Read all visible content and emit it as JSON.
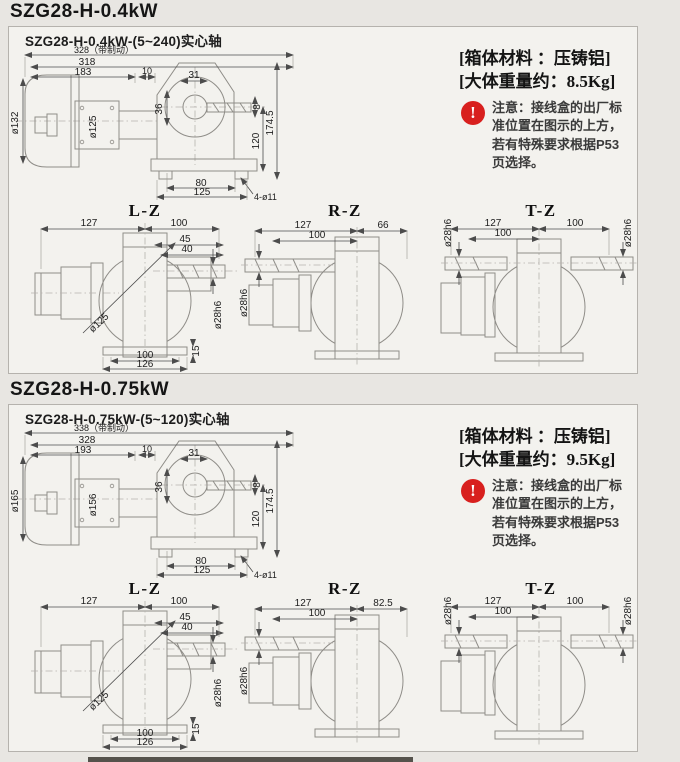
{
  "colors": {
    "page_bg": "#e8e6e2",
    "panel_bg": "#f3f2ee",
    "panel_border": "#b5b2ad",
    "outline_gray": "#8f8d88",
    "dim_line": "#4c4c4c",
    "warning_red": "#d8201e",
    "text_dark": "#151515"
  },
  "icons": {
    "warning": "!"
  },
  "sections": [
    {
      "title": "SZG28-H-0.4kW",
      "subtitle": "SZG28-H-0.4kW-(5~240)实心轴",
      "spec_material": "[箱体材料 ：压铸铝]",
      "spec_weight": "[大体重量约：8.5Kg]",
      "note_text": "注意：接线盒的出厂标准位置在图示的上方，若有特殊要求根据P53页选择。",
      "main": {
        "d_total": "328（带制动）",
        "d_len2": "318",
        "d_len3": "183",
        "d_10": "10",
        "d_31": "31",
        "dia_motor": "ø132",
        "dia_flange": "ø125",
        "d_36": "36",
        "d_8": "8",
        "d_120": "120",
        "d_height": "174.5",
        "d_80": "80",
        "d_125": "125",
        "d_holes": "4-ø11"
      },
      "lz": {
        "label": "L-Z",
        "d127": "127",
        "d100": "100",
        "d45": "45",
        "d40": "40",
        "dia": "ø125",
        "shaft": "ø28h6",
        "d15": "15",
        "b100": "100",
        "b126": "126"
      },
      "rz": {
        "label": "R-Z",
        "d127": "127",
        "d100": "100",
        "dright": "66",
        "shaft": "ø28h6"
      },
      "tz": {
        "label": "T-Z",
        "d127": "127",
        "d100": "100",
        "dright": "100",
        "shaft_left": "ø28h6",
        "shaft_right": "ø28h6"
      }
    },
    {
      "title": "SZG28-H-0.75kW",
      "subtitle": "SZG28-H-0.75kW-(5~120)实心轴",
      "spec_material": "[箱体材料 ：压铸铝]",
      "spec_weight": "[大体重量约：9.5Kg]",
      "note_text": "注意：接线盒的出厂标准位置在图示的上方，若有特殊要求根据P53页选择。",
      "main": {
        "d_total": "338（带制动）",
        "d_len2": "328",
        "d_len3": "193",
        "d_10": "10",
        "d_31": "31",
        "dia_motor": "ø165",
        "dia_flange": "ø156",
        "d_36": "36",
        "d_8": "8",
        "d_120": "120",
        "d_height": "174.5",
        "d_80": "80",
        "d_125": "125",
        "d_holes": "4-ø11"
      },
      "lz": {
        "label": "L-Z",
        "d127": "127",
        "d100": "100",
        "d45": "45",
        "d40": "40",
        "dia": "ø125",
        "shaft": "ø28h6",
        "d15": "15",
        "b100": "100",
        "b126": "126"
      },
      "rz": {
        "label": "R-Z",
        "d127": "127",
        "d100": "100",
        "dright": "82.5",
        "shaft": "ø28h6"
      },
      "tz": {
        "label": "T-Z",
        "d127": "127",
        "d100": "100",
        "dright": "100",
        "shaft_left": "ø28h6",
        "shaft_right": "ø28h6"
      }
    }
  ]
}
